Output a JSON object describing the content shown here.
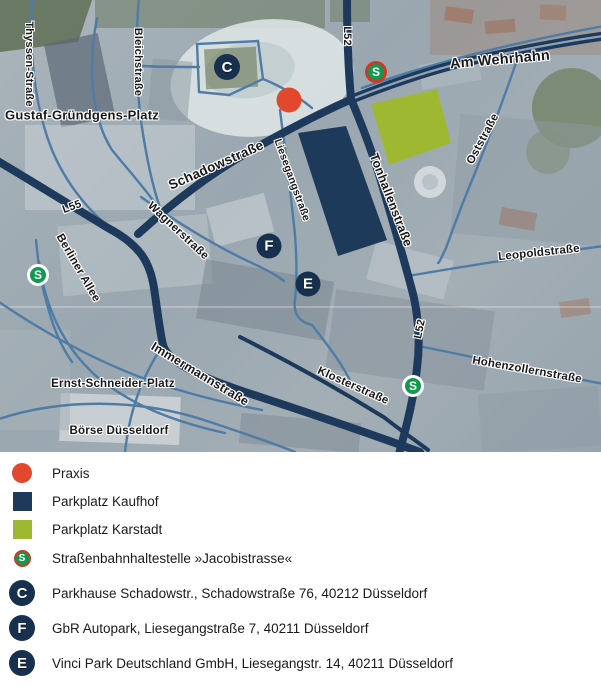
{
  "map": {
    "labels": [
      {
        "text": "Thyssen-Straße"
      },
      {
        "text": "Gustaf-Gründgens-Platz"
      },
      {
        "text": "Bleichstraße"
      },
      {
        "text": "Schadowstraße"
      },
      {
        "text": "L55"
      },
      {
        "text": "Wagnerstraße"
      },
      {
        "text": "Berliner Allee"
      },
      {
        "text": "Liesegangstraße"
      },
      {
        "text": "Tonhallenstraße"
      },
      {
        "text": "L52"
      },
      {
        "text": "Am Wehrhahn"
      },
      {
        "text": "Oststraße"
      },
      {
        "text": "Leopoldstraße"
      },
      {
        "text": "L52"
      },
      {
        "text": "Hohenzollernstraße"
      },
      {
        "text": "Klosterstraße"
      },
      {
        "text": "Immermannstraße"
      },
      {
        "text": "Ernst-Schneider-Platz"
      },
      {
        "text": "Börse Düsseldorf"
      }
    ],
    "markers": {
      "praxis": {
        "name": "Praxis"
      },
      "parkings": [
        {
          "letter": "C"
        },
        {
          "letter": "F"
        },
        {
          "letter": "E"
        }
      ],
      "stops": [
        {
          "letter": "S",
          "ring": "red"
        },
        {
          "letter": "S",
          "ring": "white"
        },
        {
          "letter": "S",
          "ring": "white"
        }
      ]
    },
    "colors": {
      "praxis_red": "#e2482e",
      "kaufhof_navy": "#1e3a5b",
      "karstadt_lime": "#9eb832",
      "stop_green": "#119a4e",
      "stop_ring_red": "#cc3928",
      "road_dark": "#1d3a5c",
      "road_light": "#4e7ca6"
    }
  },
  "legend": {
    "items": [
      {
        "label": "Praxis"
      },
      {
        "label": "Parkplatz Kaufhof"
      },
      {
        "label": "Parkplatz Karstadt"
      },
      {
        "letter": "S",
        "label": "Straßenbahnhaltestelle »Jacobistrasse«"
      },
      {
        "letter": "C",
        "label": "Parkhause Schadowstr., Schadowstraße 76, 40212 Düsseldorf"
      },
      {
        "letter": "F",
        "label": "GbR Autopark, Liesegangstraße 7, 40211 Düsseldorf"
      },
      {
        "letter": "E",
        "label": "Vinci Park Deutschland GmbH, Liesegangstr. 14, 40211 Düsseldorf"
      }
    ]
  }
}
